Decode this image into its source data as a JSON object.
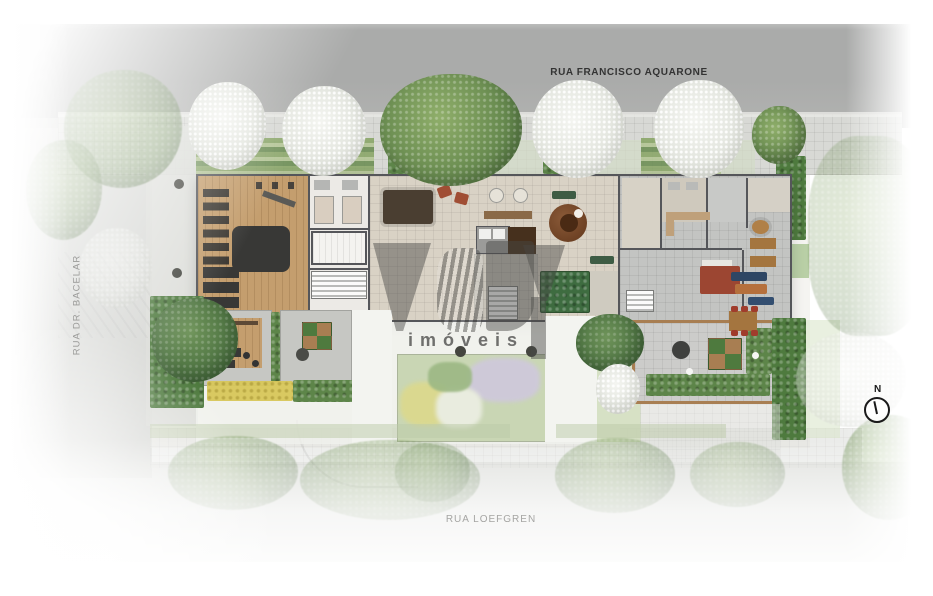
{
  "streets": {
    "top": "RUA FRANCISCO AQUARONE",
    "left": "RUA DR. BACELAR",
    "bottom": "RUA LOEFGREN"
  },
  "watermark": {
    "brand": "MBY",
    "label": "imóveis"
  },
  "compass": {
    "north": "N"
  },
  "palette": {
    "street": "#b2b3b1",
    "sidewalk": "#d8d9d5",
    "floor": "#d9d2c5",
    "wood": "#c49e6e",
    "woodframe": "#a87e52",
    "mat": "#383836",
    "wall": "#55565a",
    "room": "#eceae6",
    "grayfloor": "#c3c4c2",
    "hedge": "#5d8549",
    "hedgedark": "#4e7a3e",
    "gardenint": "#3e6c40",
    "grass": "#cfdcba",
    "rug": "#7a4a2c",
    "rugred": "#9c4632",
    "red": "#a04e34",
    "blue": "#2e4664",
    "orange": "#b5703d",
    "yellowbed": "#d8c75a",
    "lavender": "#cfc8dd",
    "greentree1": "#8fae6a",
    "greentree2": "#5d8148",
    "watermark": "rgba(72,72,70,0.5)",
    "textdark": "#333333",
    "textgray": "#9a9a98",
    "textlight": "#a5a5a3"
  }
}
